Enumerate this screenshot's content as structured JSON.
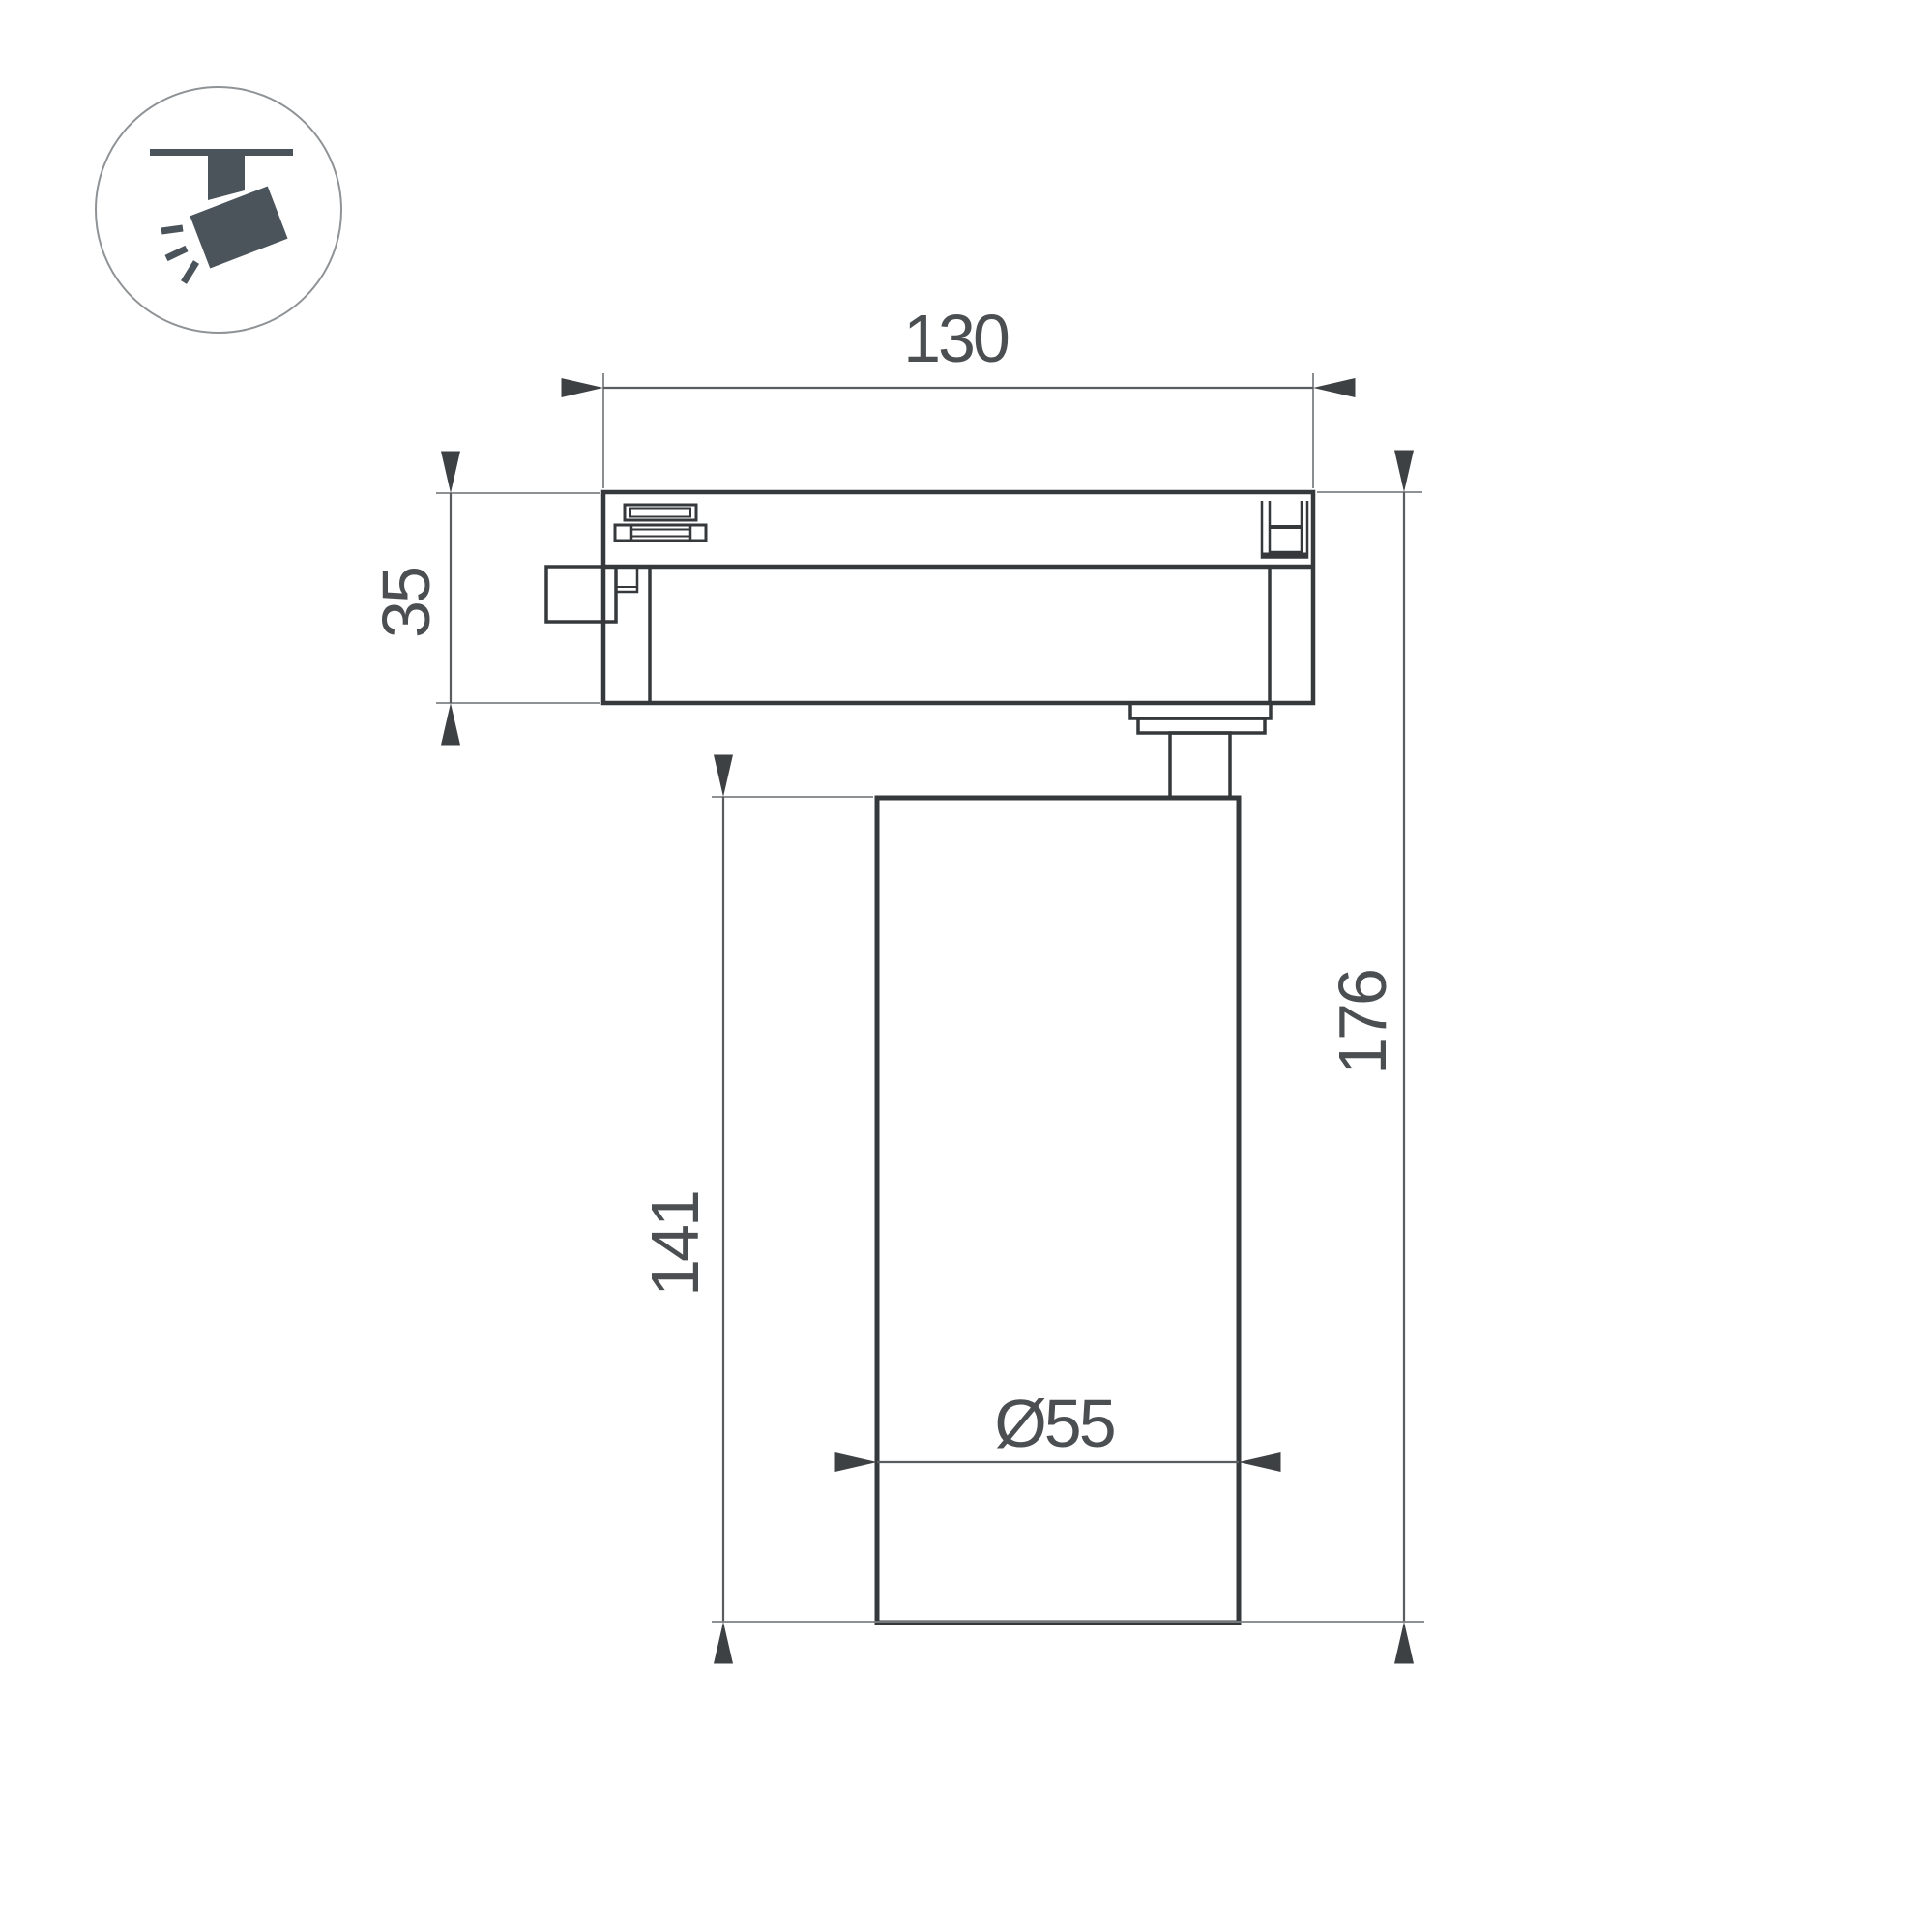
{
  "drawing": {
    "type": "technical-dimension-drawing",
    "subject": "track-mounted-spotlight",
    "views": {
      "icon_badge": "track-spotlight-pictogram"
    },
    "dimensions": {
      "track_width": {
        "label": "130"
      },
      "adapter_height": {
        "label": "35"
      },
      "body_height": {
        "label": "141"
      },
      "total_height": {
        "label": "176"
      },
      "body_diameter": {
        "label": "Ø55"
      }
    }
  },
  "colors": {
    "outline": "#35393b",
    "dim-line": "#595d60",
    "ext-line": "#7e8285",
    "arrow": "#3d4144",
    "text": "#4b4f52",
    "icon": "#4b545b",
    "icon-border": "#8f9396",
    "page-bg": "#ffffff"
  }
}
